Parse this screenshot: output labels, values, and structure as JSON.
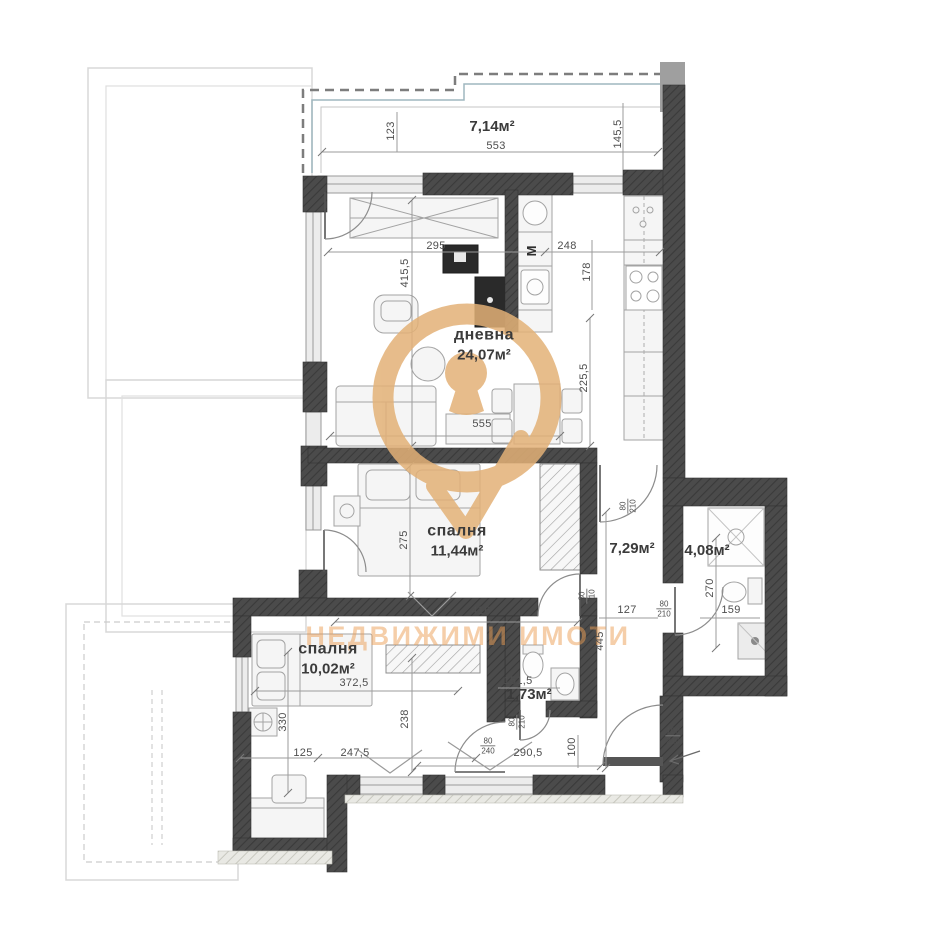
{
  "watermark": {
    "text": "НЕДВИЖИМИ ИМОТИ",
    "logo_color": "#E3B177",
    "text_color": "#EC9F56"
  },
  "kitchen": {
    "washing_machine_label": "M"
  },
  "colors": {
    "wall": "#4a4a4a",
    "dimension_text": "#4e4e4e",
    "room_label_text": "#3b3b3b"
  },
  "rooms": [
    {
      "id": "terrace",
      "name": "",
      "area": "7,14м²",
      "x": 492,
      "y": 127
    },
    {
      "id": "living",
      "name": "дневна",
      "area": "24,07м²",
      "x": 484,
      "y": 345
    },
    {
      "id": "bedroom1",
      "name": "спалня",
      "area": "11,44м²",
      "x": 457,
      "y": 541
    },
    {
      "id": "corridor",
      "name": "",
      "area": "7,29м²",
      "x": 632,
      "y": 549
    },
    {
      "id": "bathroom",
      "name": "",
      "area": "4,08м²",
      "x": 707,
      "y": 551
    },
    {
      "id": "bedroom2",
      "name": "спалня",
      "area": "10,02м²",
      "x": 328,
      "y": 659
    },
    {
      "id": "wc",
      "name": "",
      "area": "1,73м²",
      "x": 529,
      "y": 695
    }
  ],
  "dimensions": [
    {
      "text": "123",
      "x": 391,
      "y": 131,
      "rot": true
    },
    {
      "text": "553",
      "x": 496,
      "y": 146,
      "rot": false
    },
    {
      "text": "145,5",
      "x": 618,
      "y": 134,
      "rot": true
    },
    {
      "text": "295",
      "x": 436,
      "y": 246,
      "rot": false
    },
    {
      "text": "248",
      "x": 567,
      "y": 246,
      "rot": false
    },
    {
      "text": "415,5",
      "x": 405,
      "y": 273,
      "rot": true
    },
    {
      "text": "178",
      "x": 587,
      "y": 272,
      "rot": true
    },
    {
      "text": "225,5",
      "x": 584,
      "y": 378,
      "rot": true
    },
    {
      "text": "555",
      "x": 482,
      "y": 424,
      "rot": false
    },
    {
      "text": "275",
      "x": 404,
      "y": 540,
      "rot": true
    },
    {
      "text": "416",
      "x": 481,
      "y": 611,
      "rot": false
    },
    {
      "text": "127",
      "x": 627,
      "y": 610,
      "rot": false
    },
    {
      "text": "445",
      "x": 600,
      "y": 641,
      "rot": true
    },
    {
      "text": "270",
      "x": 710,
      "y": 588,
      "rot": true
    },
    {
      "text": "159",
      "x": 731,
      "y": 610,
      "rot": false
    },
    {
      "text": "151,5",
      "x": 518,
      "y": 681,
      "rot": false
    },
    {
      "text": "372,5",
      "x": 354,
      "y": 683,
      "rot": false
    },
    {
      "text": "330",
      "x": 283,
      "y": 722,
      "rot": true
    },
    {
      "text": "238",
      "x": 405,
      "y": 719,
      "rot": true
    },
    {
      "text": "125",
      "x": 303,
      "y": 753,
      "rot": false
    },
    {
      "text": "247,5",
      "x": 355,
      "y": 753,
      "rot": false
    },
    {
      "text": "290,5",
      "x": 528,
      "y": 753,
      "rot": false
    },
    {
      "text": "100",
      "x": 572,
      "y": 747,
      "rot": true
    }
  ],
  "door_labels": [
    {
      "top": "80",
      "bottom": "210",
      "x": 628,
      "y": 506,
      "rot": true
    },
    {
      "top": "80",
      "bottom": "210",
      "x": 587,
      "y": 596,
      "rot": true
    },
    {
      "top": "80",
      "bottom": "210",
      "x": 664,
      "y": 609,
      "rot": false
    },
    {
      "top": "80",
      "bottom": "210",
      "x": 517,
      "y": 722,
      "rot": true
    },
    {
      "top": "80",
      "bottom": "240",
      "x": 488,
      "y": 746,
      "rot": false
    },
    {
      "top": "100",
      "bottom": "210",
      "x": 673,
      "y": 736,
      "rot": false
    }
  ]
}
